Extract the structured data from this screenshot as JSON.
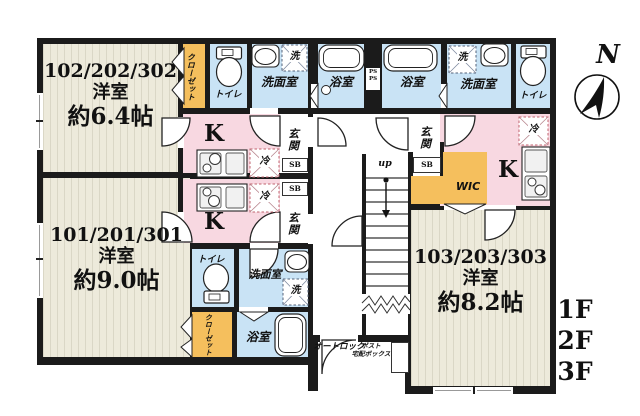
{
  "units": [
    {
      "id": "102",
      "line1": "102/202/302",
      "line2": "洋室",
      "line3": "約6.4帖"
    },
    {
      "id": "101",
      "line1": "101/201/301",
      "line2": "洋室",
      "line3": "約9.0帖"
    },
    {
      "id": "103",
      "line1": "103/203/303",
      "line2": "洋室",
      "line3": "約8.2帖"
    }
  ],
  "labels": {
    "kitchen": "K",
    "toilet": "トイレ",
    "washroom": "洗面室",
    "bathroom": "浴室",
    "washer": "洗",
    "fridge": "冷",
    "closet": "クローゼット",
    "entrance": "玄関",
    "shoe_box": "SB",
    "walk_in_closet": "WIC",
    "stairs_up": "up",
    "auto_lock": "オートロック",
    "post_line1": "ポスト",
    "post_line2": "宅配ボックス",
    "pipe_space": "PS",
    "north": "N"
  },
  "floors": [
    "1F",
    "2F",
    "3F"
  ],
  "colors": {
    "wall": "#1b1b1b",
    "flooring": "#edeadb",
    "wet_area": "#c9e3f5",
    "kitchen": "#f8d8e1",
    "storage": "#f5bf5d"
  }
}
